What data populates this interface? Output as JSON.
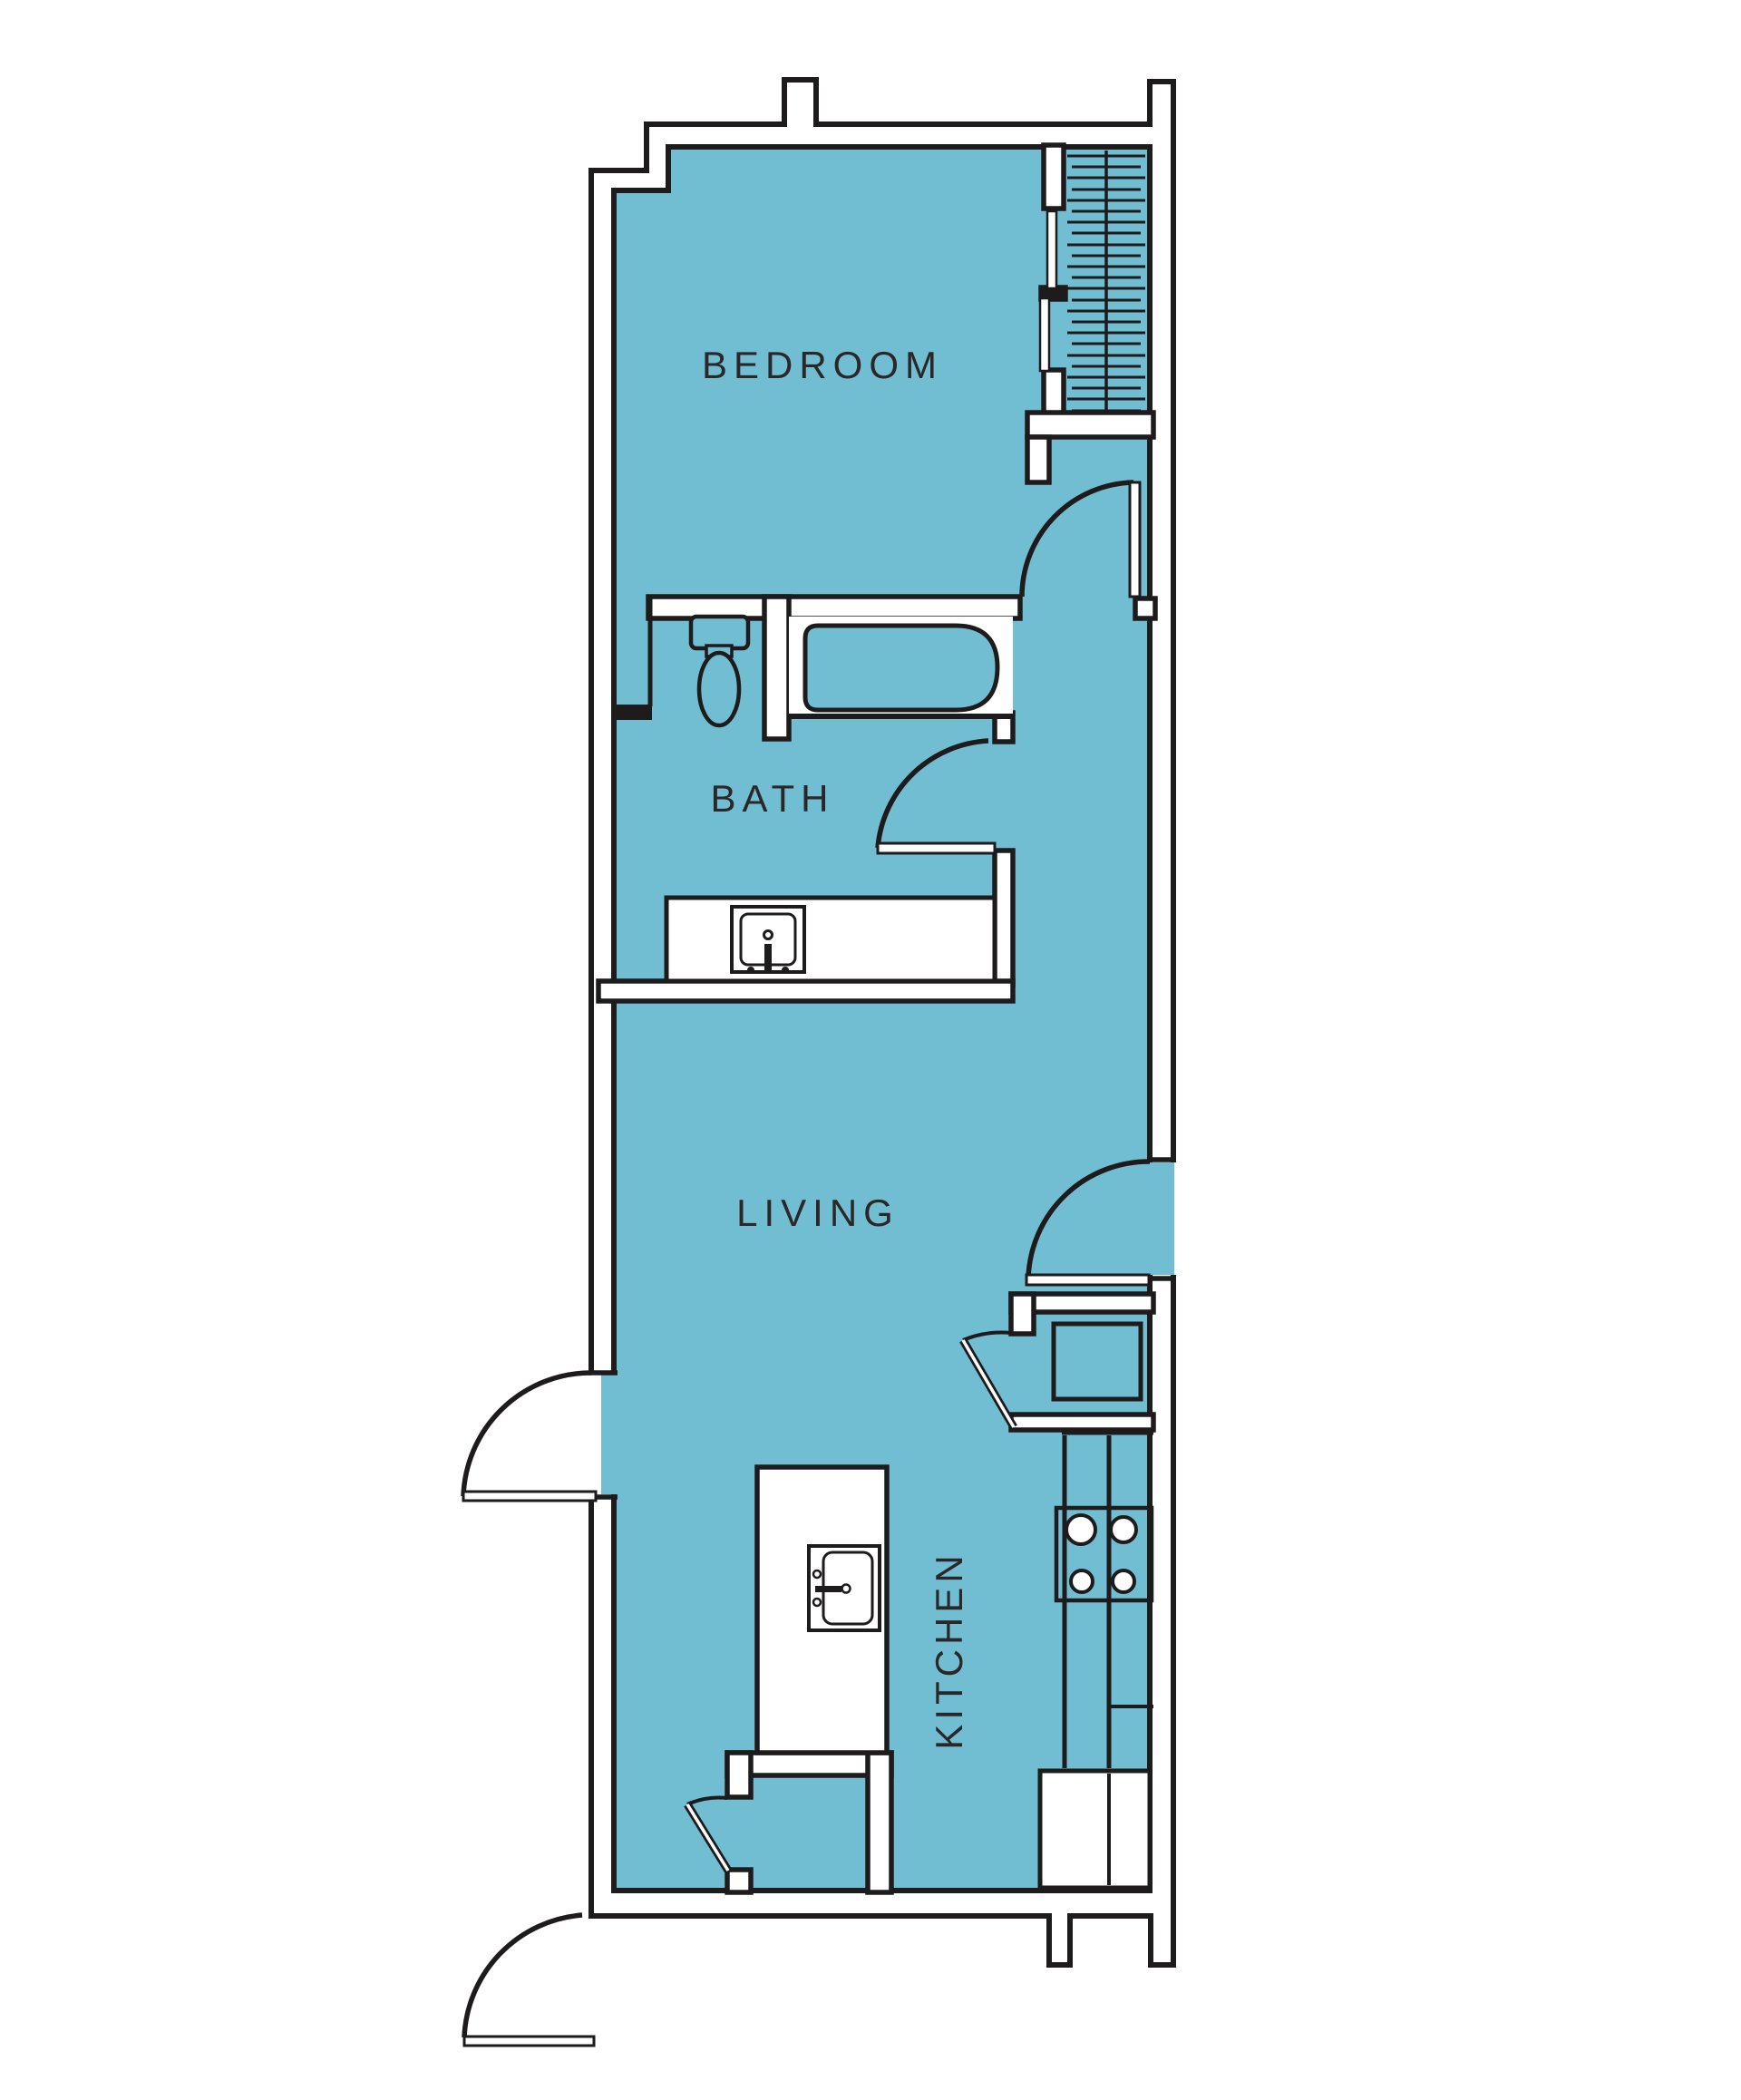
{
  "plan": {
    "type": "apartment-floor-plan",
    "palette": {
      "floor_fill": "#71bed3",
      "line_color": "#1e1b1c",
      "wall_core": "#ffffff",
      "label_color": "#2b2728"
    },
    "rooms": {
      "bedroom": {
        "label": "BEDROOM"
      },
      "bath": {
        "label": "BATH"
      },
      "living": {
        "label": "LIVING"
      },
      "kitchen": {
        "label": "KITCHEN"
      }
    },
    "fixtures": [
      "closet-hanging-rail",
      "sliding-closet-doors",
      "toilet",
      "bathtub",
      "vanity-sink",
      "kitchen-island-sink",
      "range-burners",
      "refrigerator",
      "washer-dryer-alcove",
      "pantry-closet",
      "entry-doors"
    ]
  }
}
